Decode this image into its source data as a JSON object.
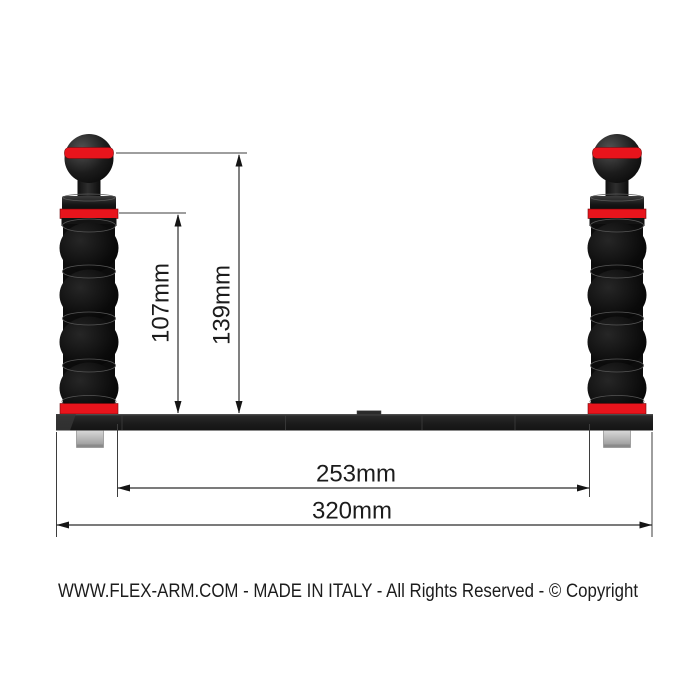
{
  "product_diagram": {
    "footer_text": "WWW.FLEX-ARM.COM - MADE IN ITALY - All Rights Reserved - © Copyright"
  },
  "dimensions": {
    "ball_top_height": {
      "label": "139mm"
    },
    "handle_top_height": {
      "label": "107mm"
    },
    "inner_handle_span": {
      "label": "253mm"
    },
    "tray_overall_width": {
      "label": "320mm"
    }
  },
  "colors": {
    "accent_red": "#e8141c",
    "part_black": "#141414",
    "bolt_grey": "#b5b5b5",
    "dimension_line": "#2c2c2c",
    "background": "#ffffff"
  }
}
